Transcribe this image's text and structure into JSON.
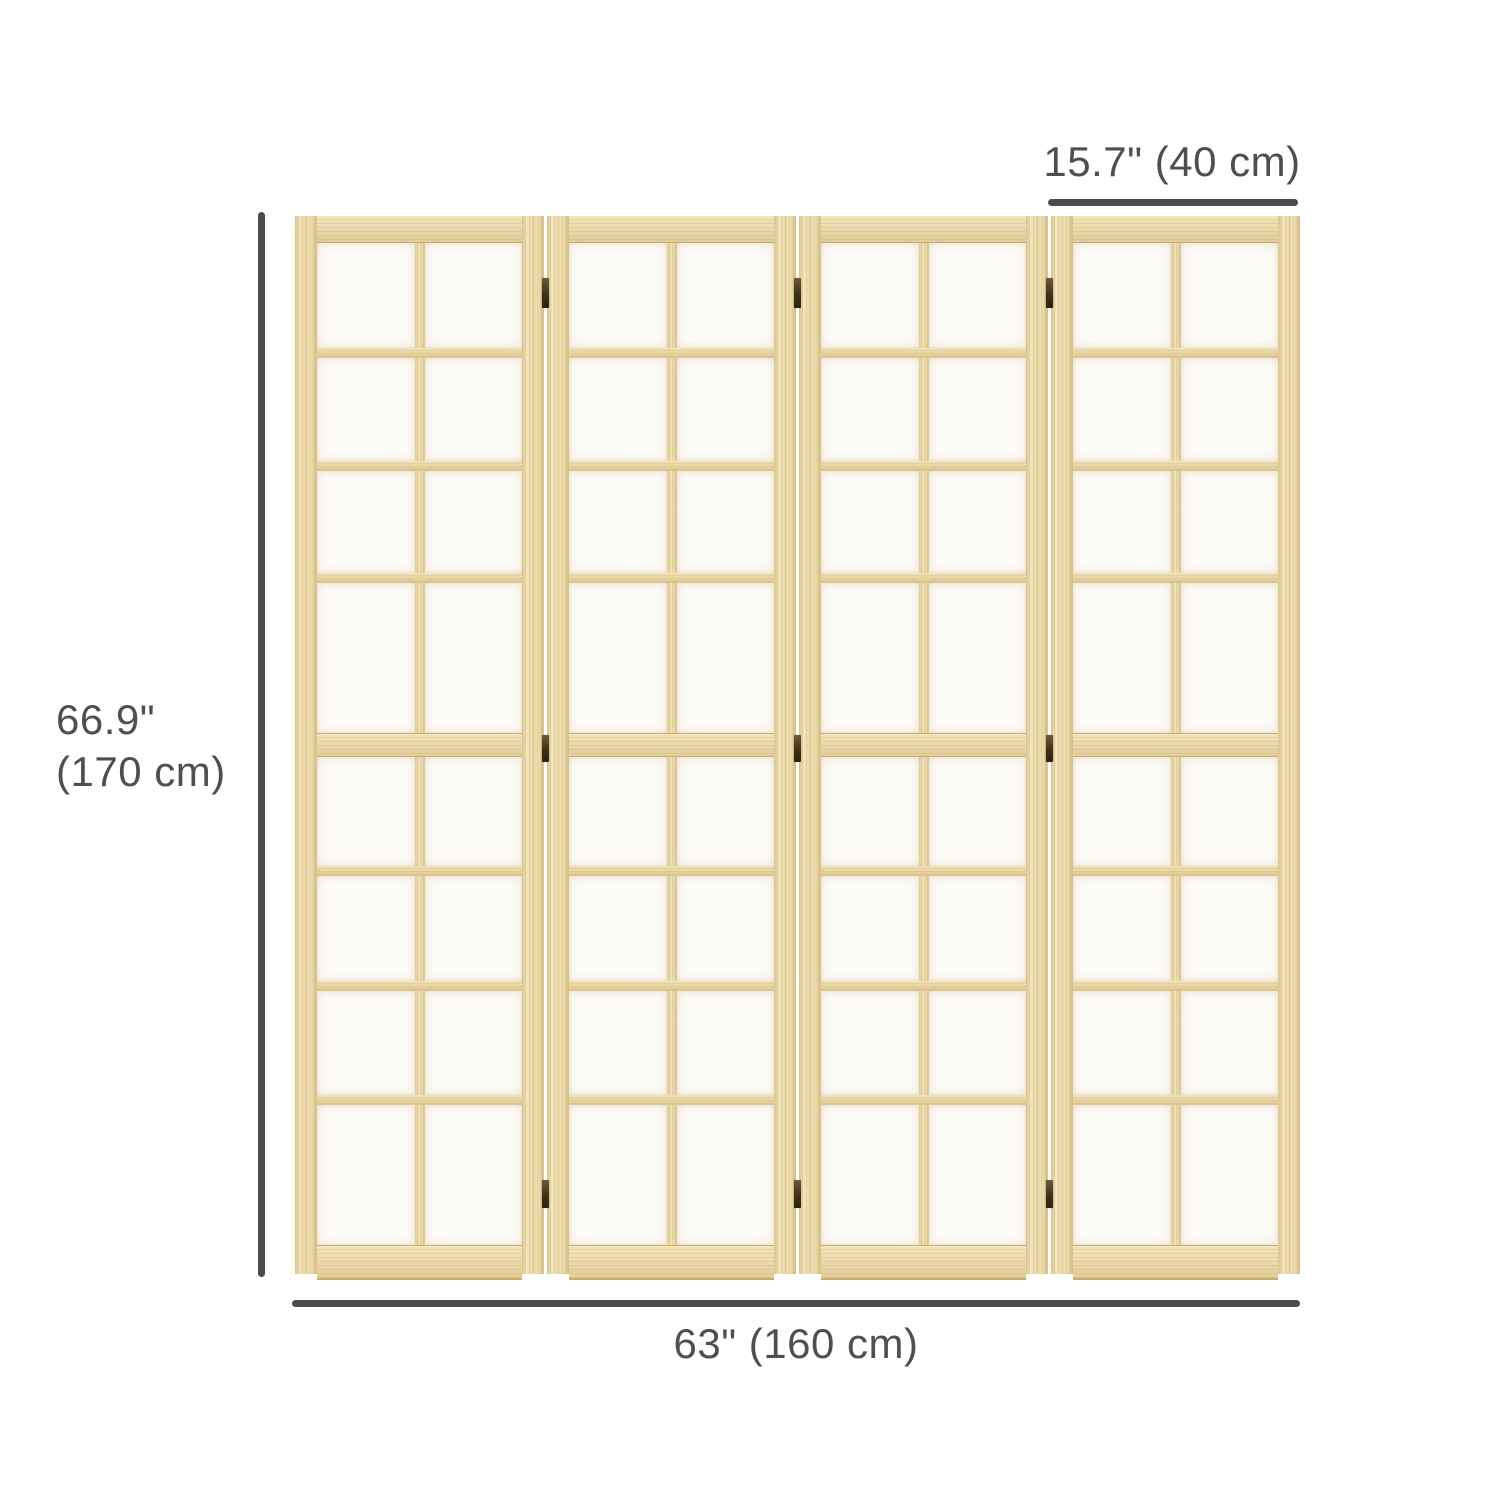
{
  "figure": {
    "name": "room-divider-dimension-diagram",
    "product": "4-panel folding screen room divider",
    "screen": {
      "panel_count": 4,
      "grid_columns": 2,
      "grid_rows": 8,
      "hinge_rows": 3,
      "hinge_gaps": 3
    }
  },
  "dimensions": {
    "panel_width_label": "15.7\" (40 cm)",
    "height_label_line1": "66.9\"",
    "height_label_line2": "(170 cm)",
    "total_width_label": "63\" (160 cm)"
  },
  "colors": {
    "wood_base": "#ecdbae",
    "wood_light": "#f5eac1",
    "wood_dark": "#d6bd82",
    "wood_edge": "#c9ad6e",
    "paper": "#fdfbf7",
    "hinge": "#3f3019",
    "dimension_line": "#4c4c4c",
    "text": "#4f4f4f",
    "background": "#ffffff"
  }
}
